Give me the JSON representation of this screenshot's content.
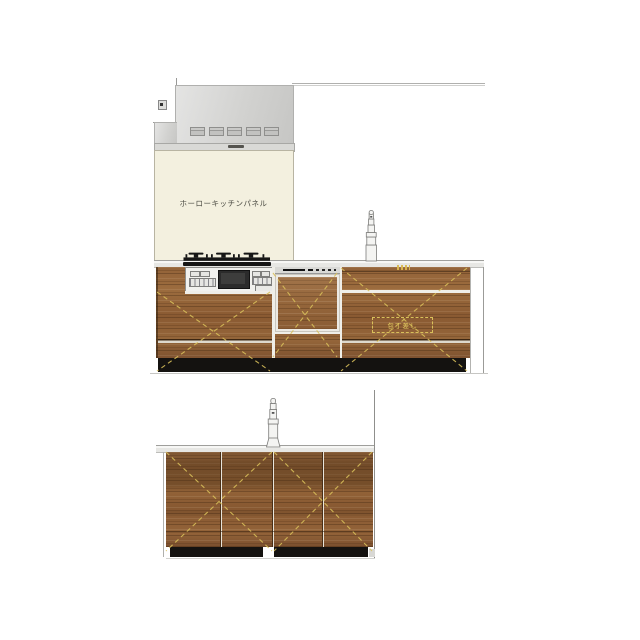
{
  "canvas": {
    "width": 640,
    "height": 640,
    "background": "#ffffff"
  },
  "annotations": {
    "panel_label": "ホーローキッチンパネル",
    "knife_pocket_label": "包丁差し"
  },
  "colors": {
    "wood": "#8f6136",
    "wood_dark": "#6b4526",
    "wood_light": "#a87c4e",
    "panel_cream": "#f3f0df",
    "hood_gray": "#d6d6d4",
    "counter_gray": "#e9e9e6",
    "dash_yellow": "#d9c05a",
    "toe_kick": "#131110",
    "appliance_face": "#f1f1ee",
    "appliance_window": "#2b2b2b",
    "floor_line": "#c6c6c3"
  }
}
